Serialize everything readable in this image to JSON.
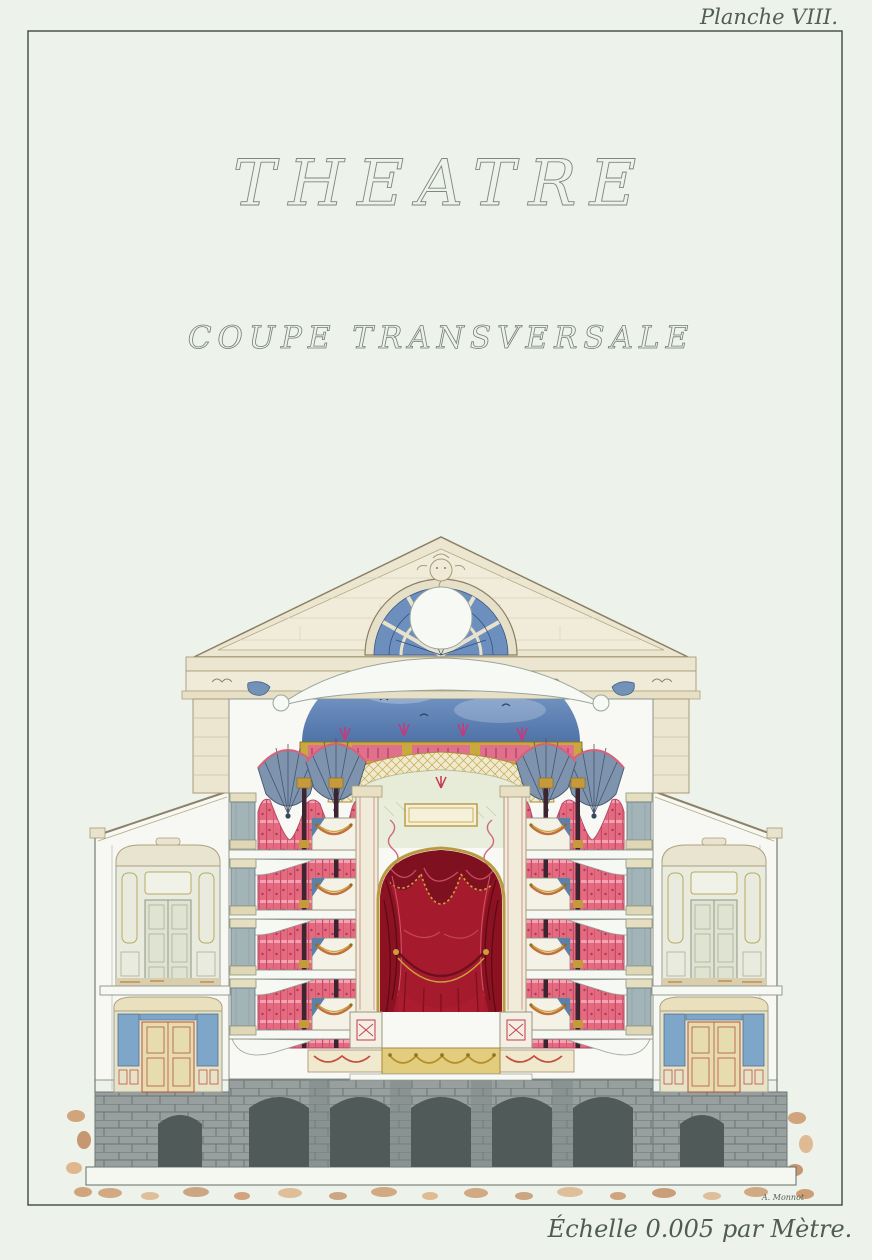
{
  "plate_label": "Planche VIII.",
  "title": "THEATRE",
  "subtitle": "COUPE TRANSVERSALE",
  "scale_caption": "Échelle 0.005 par Mètre.",
  "signature": "A. Monnot",
  "artwork": {
    "subject": "theatre transverse section",
    "medium": "watercolour architectural drawing"
  },
  "palette": {
    "paper": "#edf2ea",
    "ink": "#46504a",
    "stone_cream": "#ece6d0",
    "box_pink": "#e5697f",
    "curtain_crimson": "#a51a2c",
    "ceiling_blue": "#6d8fbe",
    "vault_blue": "#7e93ad",
    "gilt_gold": "#c8a23c",
    "panel_blue": "#7ea6c8",
    "room_green": "#e9ebdf",
    "masonry_gray": "#97a09e",
    "earth_ochre": "#c58a57"
  }
}
